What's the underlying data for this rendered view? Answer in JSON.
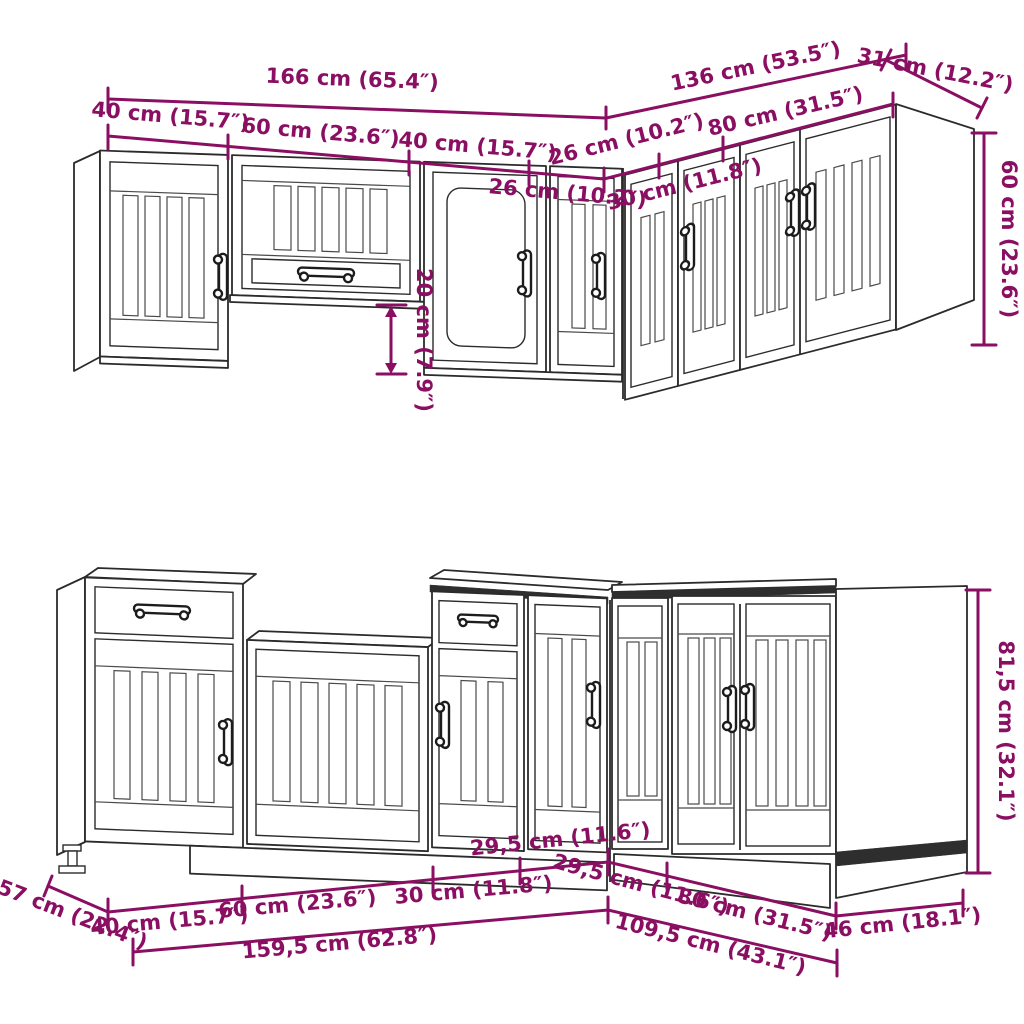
{
  "diagram": {
    "accent_color": "#8A0E62",
    "line_color": "#2b2b2b",
    "top_row": {
      "dimensions": {
        "overall_left": "166 cm (65.4″)",
        "overall_right": "136 cm (53.5″)",
        "corner_side_depth": "31 cm (12.2″)",
        "segment_40_first": "40 cm (15.7″)",
        "segment_60": "60 cm (23.6″)",
        "segment_40_second": "40 cm (15.7″)",
        "segment_26_left_of_corner": "26 cm (10.2″)",
        "segment_26_right_of_corner": "26 cm (10.2″)",
        "segment_30": "30 cm (11.8″)",
        "segment_80": "80 cm (31.5″)",
        "cabinet_height": "60 cm (23.6″)",
        "underhang_offset": "20 cm (7.9″)"
      }
    },
    "bottom_row": {
      "dimensions": {
        "side_depth_left": "57 cm (22.4″)",
        "segment_40": "40 cm (15.7″)",
        "segment_60": "60 cm (23.6″)",
        "segment_30": "30 cm (11.8″)",
        "corner_left_face": "29,5 cm (11.6″)",
        "corner_right_face": "29,5 cm (11.6″)",
        "segment_80": "80 cm (31.5″)",
        "side_depth_right": "46 cm (18.1″)",
        "overall_left_run": "159,5 cm (62.8″)",
        "overall_right_run": "109,5 cm (43.1″)",
        "cabinet_height": "81,5 cm (32.1″)"
      }
    }
  }
}
